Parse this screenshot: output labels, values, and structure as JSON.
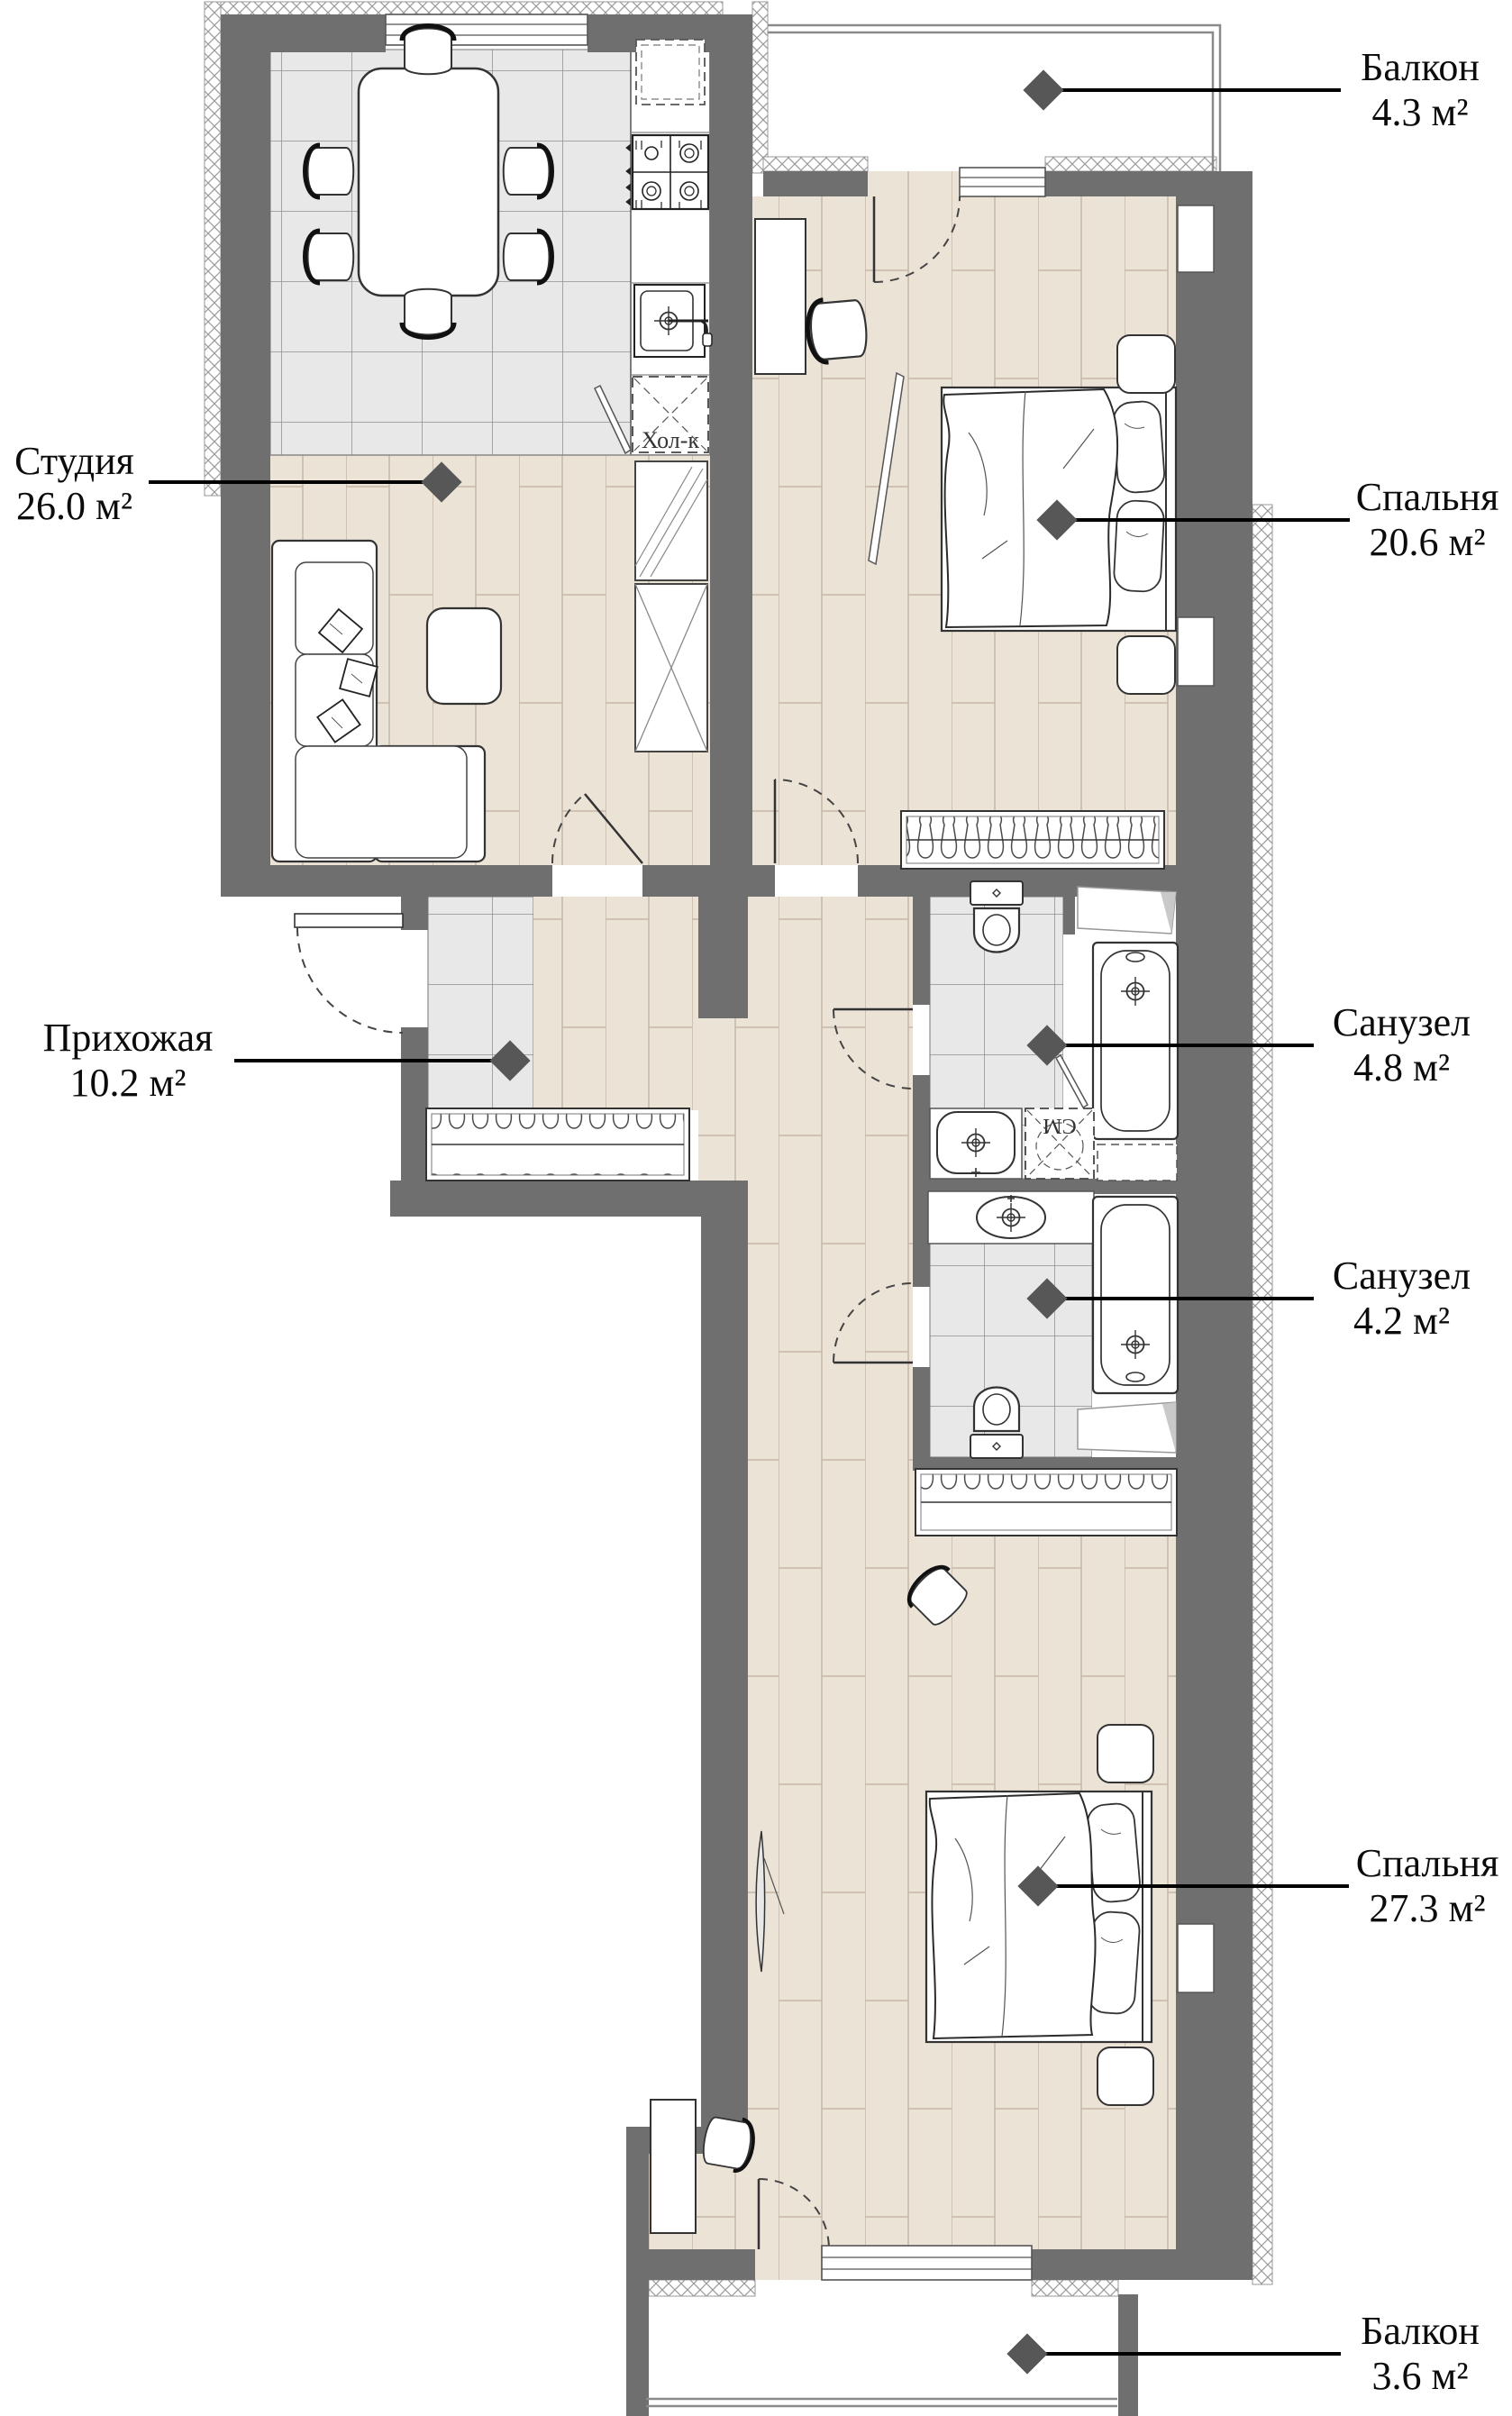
{
  "plan": {
    "rooms": [
      {
        "id": "balcony-top",
        "name": "Балкон",
        "area": "4.3 м²"
      },
      {
        "id": "bedroom-top",
        "name": "Спальня",
        "area": "20.6 м²"
      },
      {
        "id": "studio",
        "name": "Студия",
        "area": "26.0 м²"
      },
      {
        "id": "hallway",
        "name": "Прихожая",
        "area": "10.2 м²"
      },
      {
        "id": "bathroom-upper",
        "name": "Санузел",
        "area": "4.8 м²"
      },
      {
        "id": "bathroom-lower",
        "name": "Санузел",
        "area": "4.2 м²"
      },
      {
        "id": "bedroom-bottom",
        "name": "Спальня",
        "area": "27.3 м²"
      },
      {
        "id": "balcony-bottom",
        "name": "Балкон",
        "area": "3.6 м²"
      }
    ],
    "appliance_labels": {
      "fridge": "Хол-к",
      "washer": "СМ"
    },
    "colors": {
      "wall": "#6f6f6f",
      "tile_floor": "#e8e8e8",
      "wood_floor": "#ece3d7",
      "marker": "#575757",
      "leader_line": "#000000"
    }
  }
}
